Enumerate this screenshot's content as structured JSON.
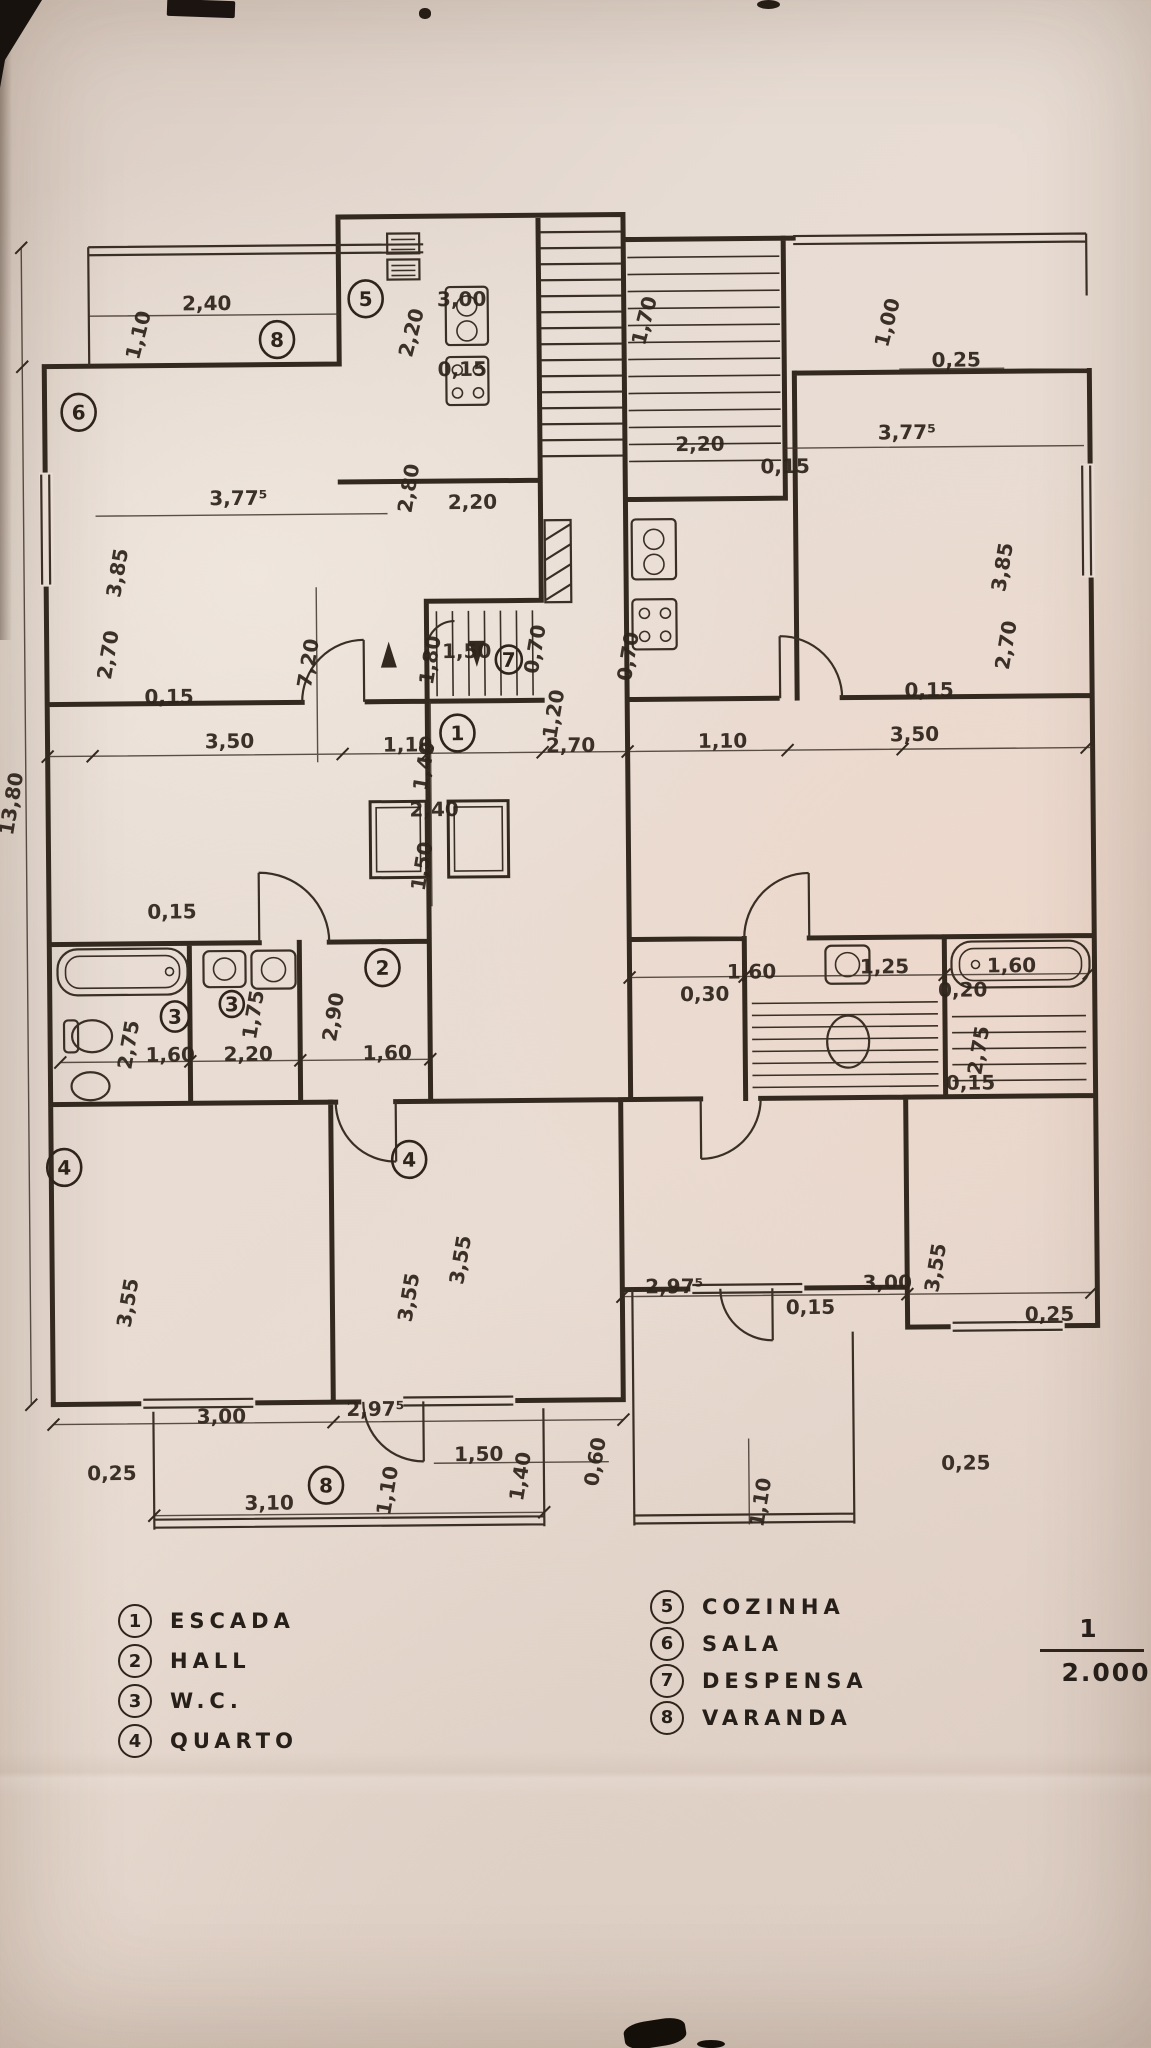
{
  "colors": {
    "paper": "#e6d9d0",
    "ink": "#33291f"
  },
  "legend_left": [
    {
      "num": "1",
      "label": "ESCADA"
    },
    {
      "num": "2",
      "label": "HALL"
    },
    {
      "num": "3",
      "label": "W.C."
    },
    {
      "num": "4",
      "label": "QUARTO"
    }
  ],
  "legend_right": [
    {
      "num": "5",
      "label": "COZINHA"
    },
    {
      "num": "6",
      "label": "SALA"
    },
    {
      "num": "7",
      "label": "DESPENSA"
    },
    {
      "num": "8",
      "label": "VARANDA"
    }
  ],
  "scale": {
    "numerator": "1",
    "denominator": "2.000"
  },
  "plan": {
    "labels": [
      {
        "t": "2,40",
        "x": 213,
        "y": 307
      },
      {
        "t": "1,10",
        "x": 151,
        "y": 333,
        "r": -75
      },
      {
        "t": "3,00",
        "x": 468,
        "y": 305
      },
      {
        "t": "0,15",
        "x": 468,
        "y": 375
      },
      {
        "t": "2,20",
        "x": 424,
        "y": 333,
        "r": -75
      },
      {
        "t": "1,70",
        "x": 657,
        "y": 323,
        "r": -75
      },
      {
        "t": "2,20",
        "x": 705,
        "y": 452
      },
      {
        "t": "0,15",
        "x": 790,
        "y": 475
      },
      {
        "t": "3,77⁵",
        "x": 912,
        "y": 442
      },
      {
        "t": "1,00",
        "x": 900,
        "y": 327,
        "r": -75
      },
      {
        "t": "0,25",
        "x": 962,
        "y": 370
      },
      {
        "t": "2,80",
        "x": 420,
        "y": 488,
        "r": -80
      },
      {
        "t": "3,77⁵",
        "x": 243,
        "y": 502
      },
      {
        "t": "3,85",
        "x": 128,
        "y": 570,
        "r": -80
      },
      {
        "t": "2,20",
        "x": 477,
        "y": 508
      },
      {
        "t": "3,85",
        "x": 1013,
        "y": 572,
        "r": -80
      },
      {
        "t": "1,50",
        "x": 470,
        "y": 657
      },
      {
        "t": "0,70",
        "x": 545,
        "y": 650,
        "r": -80
      },
      {
        "t": "0,70",
        "x": 638,
        "y": 658,
        "r": -80
      },
      {
        "t": "2,70",
        "x": 118,
        "y": 652,
        "r": -80
      },
      {
        "t": "2,70",
        "x": 1016,
        "y": 650,
        "r": -80
      },
      {
        "t": "7,20",
        "x": 318,
        "y": 662,
        "r": -80
      },
      {
        "t": "1,80",
        "x": 440,
        "y": 660,
        "r": -80
      },
      {
        "t": "0,15",
        "x": 172,
        "y": 700
      },
      {
        "t": "3,50",
        "x": 232,
        "y": 745
      },
      {
        "t": "1,10",
        "x": 410,
        "y": 750
      },
      {
        "t": "2,70",
        "x": 573,
        "y": 752
      },
      {
        "t": "1,20",
        "x": 563,
        "y": 715,
        "r": -80
      },
      {
        "t": "1,10",
        "x": 725,
        "y": 749
      },
      {
        "t": "3,50",
        "x": 917,
        "y": 744
      },
      {
        "t": "0,15",
        "x": 932,
        "y": 700
      },
      {
        "t": "1,40",
        "x": 433,
        "y": 766,
        "r": -80
      },
      {
        "t": "2,40",
        "x": 436,
        "y": 815
      },
      {
        "t": "1,50",
        "x": 430,
        "y": 866,
        "r": -80
      },
      {
        "t": "0,15",
        "x": 173,
        "y": 915
      },
      {
        "t": "2,75",
        "x": 135,
        "y": 1042,
        "r": -80
      },
      {
        "t": "1,75",
        "x": 260,
        "y": 1013,
        "r": -80
      },
      {
        "t": "1,60",
        "x": 170,
        "y": 1058
      },
      {
        "t": "2,20",
        "x": 248,
        "y": 1058
      },
      {
        "t": "2,90",
        "x": 340,
        "y": 1016,
        "r": -80
      },
      {
        "t": "1,60",
        "x": 387,
        "y": 1058
      },
      {
        "t": "1,60",
        "x": 752,
        "y": 980
      },
      {
        "t": "0,30",
        "x": 705,
        "y": 1002
      },
      {
        "t": "1,25",
        "x": 885,
        "y": 976
      },
      {
        "t": "0,20",
        "x": 963,
        "y": 1000
      },
      {
        "t": "1,60",
        "x": 1012,
        "y": 976
      },
      {
        "t": "2,75",
        "x": 985,
        "y": 1055,
        "r": -80
      },
      {
        "t": "0,15",
        "x": 970,
        "y": 1093
      },
      {
        "t": "3,55",
        "x": 132,
        "y": 1300,
        "r": -80
      },
      {
        "t": "3,55",
        "x": 413,
        "y": 1297,
        "r": -80
      },
      {
        "t": "3,55",
        "x": 465,
        "y": 1260,
        "r": -80
      },
      {
        "t": "3,55",
        "x": 940,
        "y": 1272,
        "r": -80
      },
      {
        "t": "2,97⁵",
        "x": 672,
        "y": 1294
      },
      {
        "t": "3,00",
        "x": 885,
        "y": 1292
      },
      {
        "t": "0,15",
        "x": 808,
        "y": 1316
      },
      {
        "t": "0,25",
        "x": 1047,
        "y": 1325
      },
      {
        "t": "3,00",
        "x": 218,
        "y": 1420
      },
      {
        "t": "2,97⁵",
        "x": 372,
        "y": 1414
      },
      {
        "t": "0,25",
        "x": 108,
        "y": 1476
      },
      {
        "t": "3,10",
        "x": 265,
        "y": 1507
      },
      {
        "t": "1,10",
        "x": 390,
        "y": 1490,
        "r": -80
      },
      {
        "t": "1,50",
        "x": 475,
        "y": 1460
      },
      {
        "t": "1,40",
        "x": 523,
        "y": 1477,
        "r": -80
      },
      {
        "t": "0,60",
        "x": 598,
        "y": 1463,
        "r": -80
      },
      {
        "t": "1,10",
        "x": 763,
        "y": 1505,
        "r": -80
      },
      {
        "t": "0,25",
        "x": 962,
        "y": 1473
      },
      {
        "t": "13,80",
        "x": 20,
        "y": 800,
        "r": -80,
        "s": 23
      }
    ],
    "markers": [
      {
        "n": "8",
        "x": 283,
        "y": 337
      },
      {
        "n": "5",
        "x": 372,
        "y": 297
      },
      {
        "n": "6",
        "x": 84,
        "y": 408
      },
      {
        "n": "7",
        "x": 512,
        "y": 659,
        "s": 26,
        "fs": 16
      },
      {
        "n": "1",
        "x": 460,
        "y": 732
      },
      {
        "n": "2",
        "x": 383,
        "y": 966
      },
      {
        "n": "3",
        "x": 175,
        "y": 1013,
        "s": 28,
        "fs": 17
      },
      {
        "n": "3",
        "x": 232,
        "y": 1001,
        "s": 24,
        "fs": 15
      },
      {
        "n": "4",
        "x": 63,
        "y": 1163
      },
      {
        "n": "4",
        "x": 408,
        "y": 1158
      },
      {
        "n": "8",
        "x": 322,
        "y": 1483
      }
    ]
  }
}
